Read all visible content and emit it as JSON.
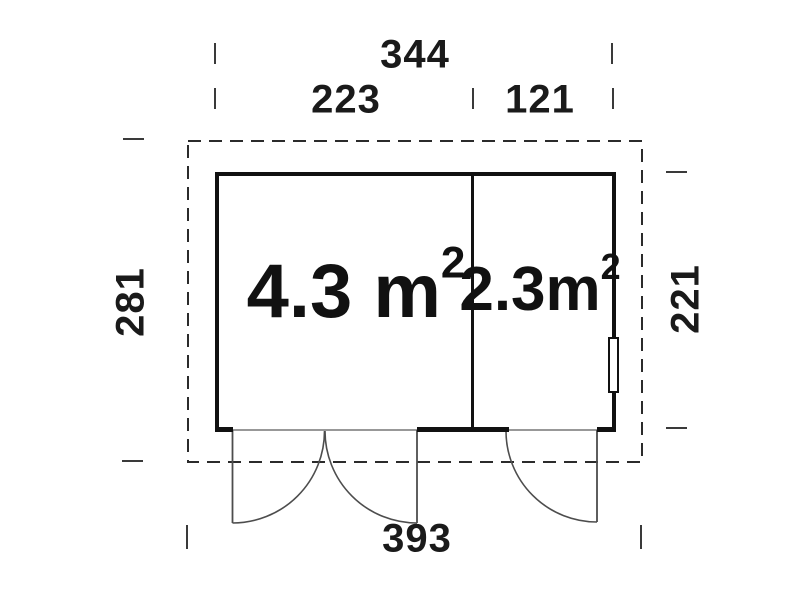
{
  "drawing": {
    "type": "floor-plan",
    "unit": "cm",
    "dimensions": {
      "overall_width": "344",
      "left_section_width": "223",
      "right_section_width": "121",
      "overall_depth": "281",
      "wall_depth": "221",
      "base_width": "393"
    },
    "rooms": [
      {
        "name": "main-room",
        "area_label": "4.3 m",
        "area_sup": "2"
      },
      {
        "name": "side-room",
        "area_label": "2.3m",
        "area_sup": "2"
      }
    ],
    "features": {
      "doors": [
        "double-door-main-room",
        "single-door-side-room"
      ],
      "window": "right-wall-window"
    },
    "colors": {
      "wall_line": "#111111",
      "door_line": "#4d4d4d",
      "dashed_outline": "#2b2b2b",
      "tick": "#3a3a3a",
      "background": "#ffffff"
    }
  }
}
